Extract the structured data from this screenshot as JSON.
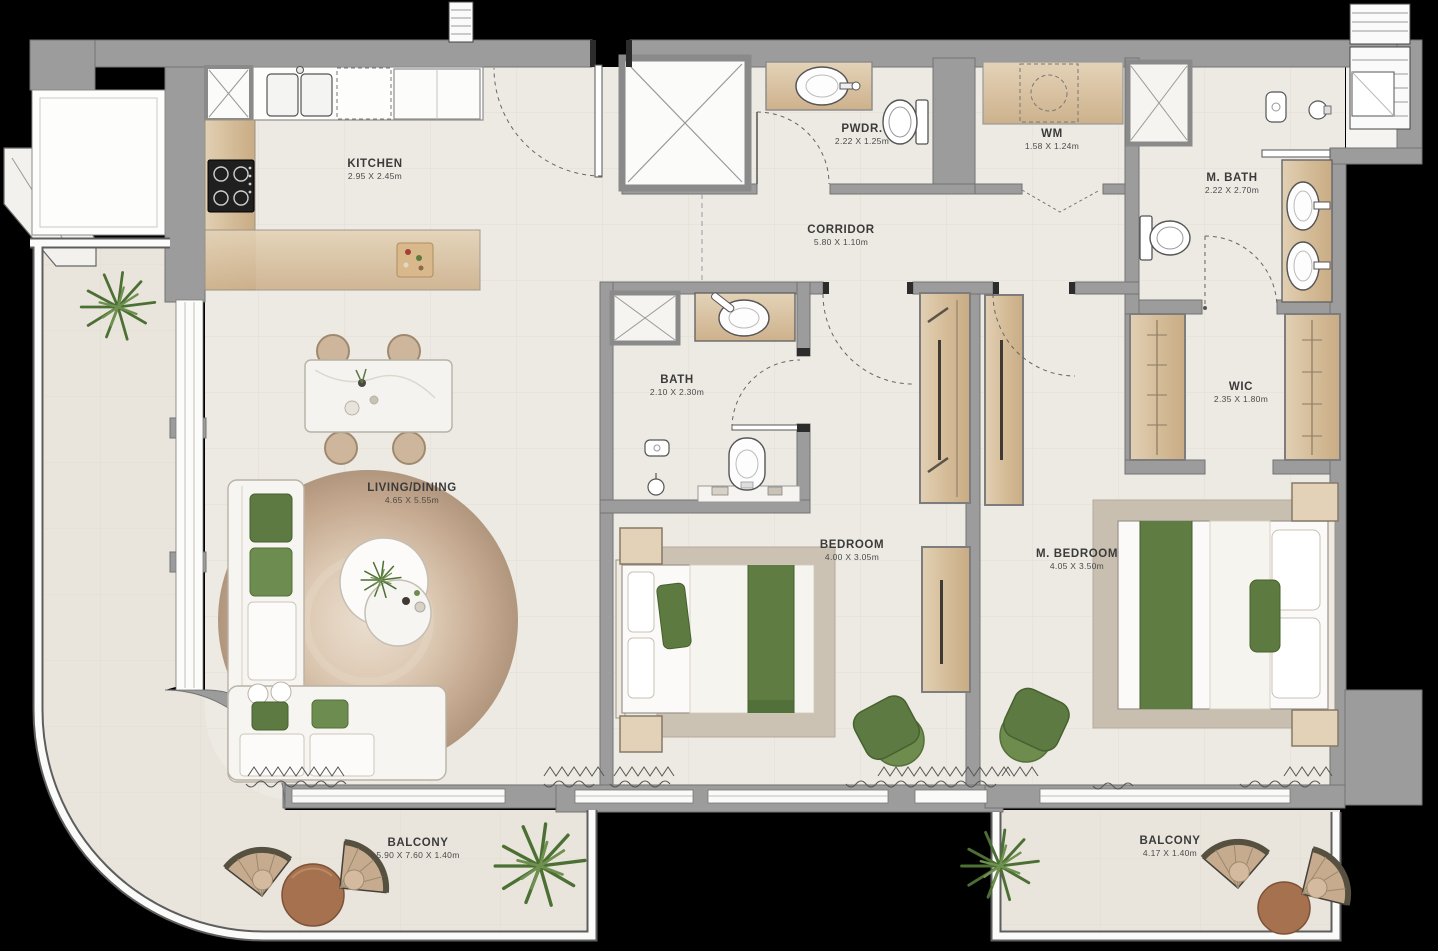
{
  "plan": {
    "rooms": {
      "kitchen": {
        "name": "KITCHEN",
        "dims": "2.95 X 2.45m"
      },
      "pwdr": {
        "name": "PWDR.",
        "dims": "2.22 X 1.25m"
      },
      "wm": {
        "name": "WM",
        "dims": "1.58 X 1.24m"
      },
      "m_bath": {
        "name": "M. BATH",
        "dims": "2.22 X 2.70m"
      },
      "corridor": {
        "name": "CORRIDOR",
        "dims": "5.80 X 1.10m"
      },
      "bath": {
        "name": "BATH",
        "dims": "2.10 X 2.30m"
      },
      "wic": {
        "name": "WIC",
        "dims": "2.35 X 1.80m"
      },
      "living": {
        "name": "LIVING/DINING",
        "dims": "4.65 X 5.55m"
      },
      "bedroom": {
        "name": "BEDROOM",
        "dims": "4.00 X 3.05m"
      },
      "m_bedroom": {
        "name": "M. BEDROOM",
        "dims": "4.05 X 3.50m"
      },
      "balcony_main": {
        "name": "BALCONY",
        "dims": "5.90 X 7.60 X 1.40m"
      },
      "balcony_master": {
        "name": "BALCONY",
        "dims": "4.17 X 1.40m"
      }
    },
    "colors": {
      "wall": "#9c9c9c",
      "floor": "#edeae3",
      "balcony_floor": "#e9e5dc",
      "wood": "#dcc9ab",
      "accent_green": "#5d7a42",
      "rug_brown": "#c2a78f",
      "terracotta": "#a5714e",
      "label_text": "#3b3b3b"
    }
  }
}
